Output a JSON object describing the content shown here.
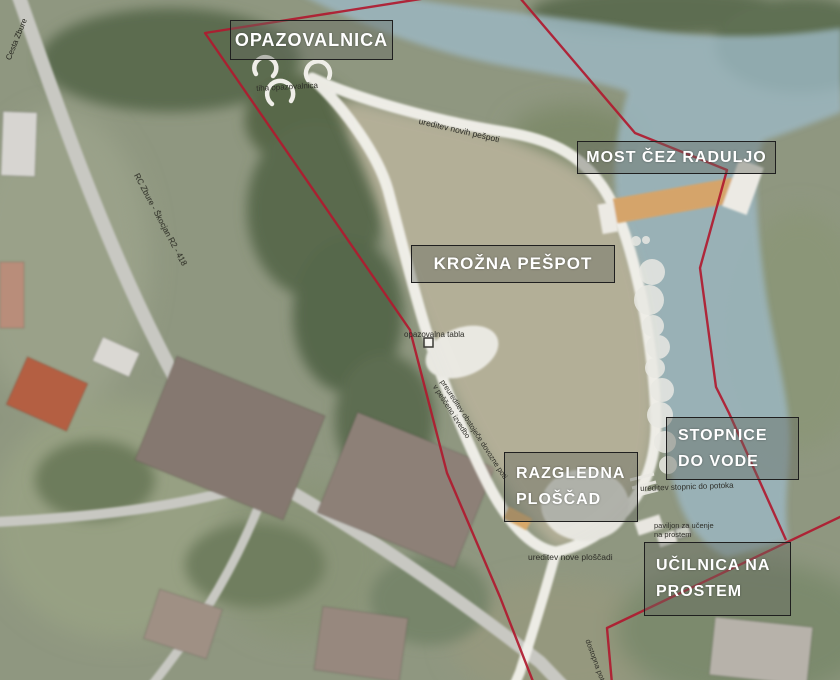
{
  "labels": {
    "opazovalnica": "OPAZOVALNICA",
    "most": "MOST ČEZ RADULJO",
    "krozna": "KROŽNA PEŠPOT",
    "razgledna_l1": "RAZGLEDNA",
    "razgledna_l2": "PLOŠČAD",
    "stopnice_l1": "STOPNICE",
    "stopnice_l2": "DO VODE",
    "ucilnica_l1": "UČILNICA NA",
    "ucilnica_l2": "PROSTEM"
  },
  "annotations": {
    "tiha": "tiha opazovalnica",
    "nove_pespoti": "ureditev novih pešpoti",
    "tabla": "opazovalna tabla",
    "preureditev_l1": "preureditev obstoječe dovozne poti",
    "preureditev_l2": "v peščeno izvedbo",
    "stopnic": "ureditev stopnic do potoka",
    "paviljon_l1": "paviljon za učenje",
    "paviljon_l2": "na prostem",
    "ploscad": "ureditev nove ploščadi",
    "dostop": "dostopna pot",
    "road_top": "Cesta Zbure",
    "road_main": "RC Zbure - Škocjan R2 - 418"
  },
  "colors": {
    "site_boundary_red": "#b01a2f",
    "river_blue": "#9cb7c2",
    "footpath_white": "#f1f0ea",
    "bridge_tan": "#d5a46b",
    "meadow_beige": "#b3af97",
    "woods_green": "#5c6c50",
    "label_text": "#ffffff",
    "label_border": "#1f1f1f"
  }
}
